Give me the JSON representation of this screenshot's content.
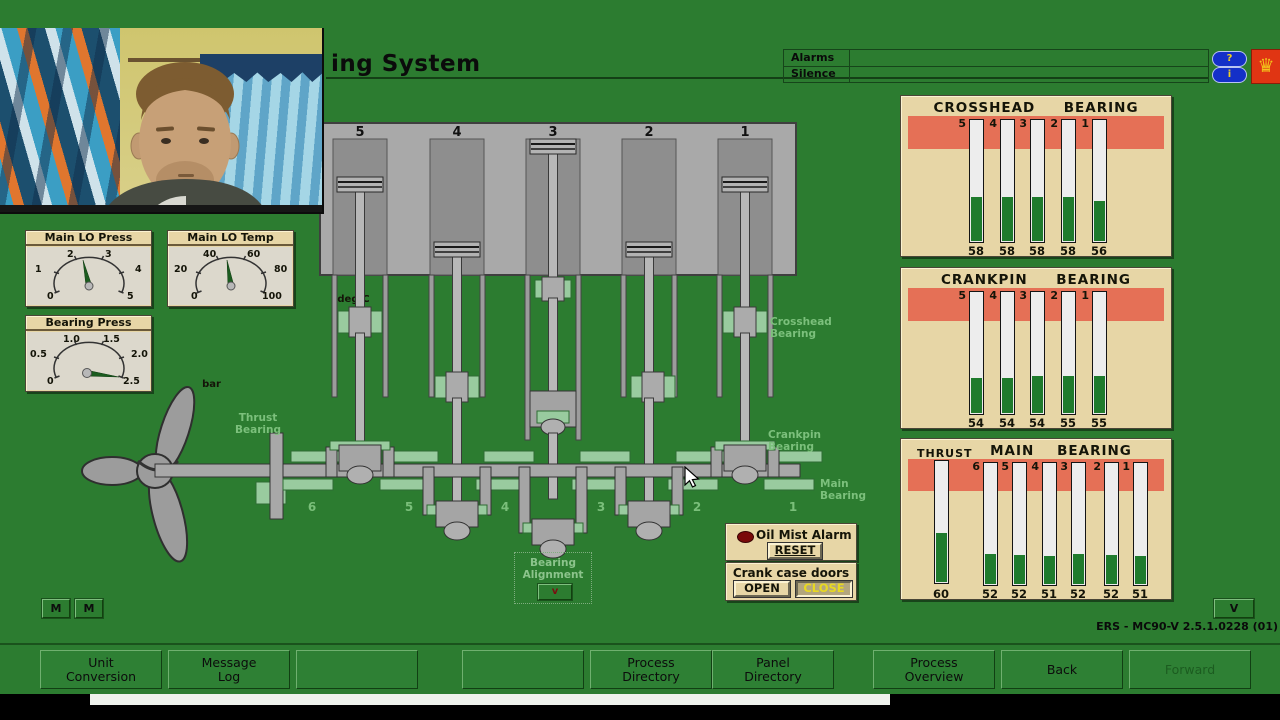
{
  "window": {
    "minimize_icon": "—",
    "restore_icon": "❐",
    "close_icon": "✕"
  },
  "header": {
    "title_visible": "ing System",
    "alarms_label": "Alarms",
    "silence_label": "Silence",
    "help_label": "?",
    "info_label": "i",
    "crest_glyph": "♛",
    "colors": {
      "app_green": "#2c7c30",
      "panel_beige": "#e7d6a6",
      "alert_red_band": "#e57056",
      "bar_green": "#1f7b2d"
    }
  },
  "gauges": {
    "main_lo_press": {
      "title": "Main LO Press",
      "unit": "bar",
      "ticks": [
        "0",
        "1",
        "2",
        "3",
        "4",
        "5"
      ],
      "value": "2.3"
    },
    "main_lo_temp": {
      "title": "Main LO Temp",
      "unit": "deg.C",
      "ticks": [
        "0",
        "20",
        "40",
        "60",
        "80",
        "100"
      ],
      "value": "47"
    },
    "bearing_press": {
      "title": "Bearing Press",
      "unit": "bar",
      "ticks": [
        "0",
        "0.5",
        "1.0",
        "1.5",
        "2.0",
        "2.5"
      ],
      "value": "2.3"
    }
  },
  "panels": {
    "crosshead": {
      "title1": "CROSSHEAD",
      "title2": "BEARING",
      "slots": [
        {
          "num": "5",
          "value": "58",
          "fill": 36
        },
        {
          "num": "4",
          "value": "58",
          "fill": 36
        },
        {
          "num": "3",
          "value": "58",
          "fill": 36
        },
        {
          "num": "2",
          "value": "58",
          "fill": 36
        },
        {
          "num": "1",
          "value": "56",
          "fill": 33
        }
      ]
    },
    "crankpin": {
      "title1": "CRANKPIN",
      "title2": "BEARING",
      "slots": [
        {
          "num": "5",
          "value": "54",
          "fill": 29
        },
        {
          "num": "4",
          "value": "54",
          "fill": 29
        },
        {
          "num": "3",
          "value": "54",
          "fill": 30
        },
        {
          "num": "2",
          "value": "55",
          "fill": 30
        },
        {
          "num": "1",
          "value": "55",
          "fill": 30
        }
      ]
    },
    "thrust_main": {
      "thrust_label": "THRUST",
      "title1": "MAIN",
      "title2": "BEARING",
      "thrust": {
        "value": "60",
        "fill": 40
      },
      "slots": [
        {
          "num": "6",
          "value": "52",
          "fill": 25
        },
        {
          "num": "5",
          "value": "52",
          "fill": 24
        },
        {
          "num": "4",
          "value": "51",
          "fill": 23
        },
        {
          "num": "3",
          "value": "52",
          "fill": 25
        },
        {
          "num": "2",
          "value": "52",
          "fill": 24
        },
        {
          "num": "1",
          "value": "51",
          "fill": 23
        }
      ]
    }
  },
  "diagram": {
    "cylinders": [
      "5",
      "4",
      "3",
      "2",
      "1"
    ],
    "shaft_bearing_numbers": [
      "6",
      "5",
      "4",
      "3",
      "2",
      "1"
    ],
    "labels": {
      "thrust_line1": "Thrust",
      "thrust_line2": "Bearing",
      "crosshead_line1": "Crosshead",
      "crosshead_line2": "Bearing",
      "crankpin_line1": "Crankpin",
      "crankpin_line2": "Bearing",
      "main_line1": "Main",
      "main_line2": "Bearing"
    },
    "bearing_alignment": {
      "line1": "Bearing",
      "line2": "Alignment",
      "button": "v"
    }
  },
  "oil_mist": {
    "label": "Oil Mist Alarm",
    "reset": "RESET"
  },
  "crankcase": {
    "label": "Crank case doors",
    "open": "OPEN",
    "close": "CLOSE"
  },
  "misc": {
    "m1": "M",
    "m2": "M",
    "v": "V",
    "version": "ERS - MC90-V 2.5.1.0228 (01)"
  },
  "toolbar": {
    "buttons": [
      {
        "line1": "Unit",
        "line2": "Conversion"
      },
      {
        "line1": "Message",
        "line2": "Log"
      },
      {
        "line1": "",
        "line2": ""
      },
      {
        "line1": "",
        "line2": ""
      },
      {
        "line1": "Process",
        "line2": "Directory"
      },
      {
        "line1": "Panel",
        "line2": "Directory"
      },
      {
        "line1": "Process",
        "line2": "Overview"
      },
      {
        "line1": "Back",
        "line2": ""
      },
      {
        "line1": "Forward",
        "line2": ""
      }
    ]
  },
  "chart_data": [
    {
      "type": "bar",
      "title": "CROSSHEAD BEARING",
      "categories": [
        "5",
        "4",
        "3",
        "2",
        "1"
      ],
      "values": [
        58,
        58,
        58,
        58,
        56
      ],
      "ylabel": "temperature deg.C",
      "legend_position": "none",
      "grid": false
    },
    {
      "type": "bar",
      "title": "CRANKPIN BEARING",
      "categories": [
        "5",
        "4",
        "3",
        "2",
        "1"
      ],
      "values": [
        54,
        54,
        54,
        55,
        55
      ],
      "ylabel": "temperature deg.C",
      "legend_position": "none",
      "grid": false
    },
    {
      "type": "bar",
      "title": "THRUST / MAIN BEARING",
      "categories": [
        "THRUST",
        "6",
        "5",
        "4",
        "3",
        "2",
        "1"
      ],
      "values": [
        60,
        52,
        52,
        51,
        52,
        52,
        51
      ],
      "ylabel": "temperature deg.C",
      "legend_position": "none",
      "grid": false
    }
  ]
}
